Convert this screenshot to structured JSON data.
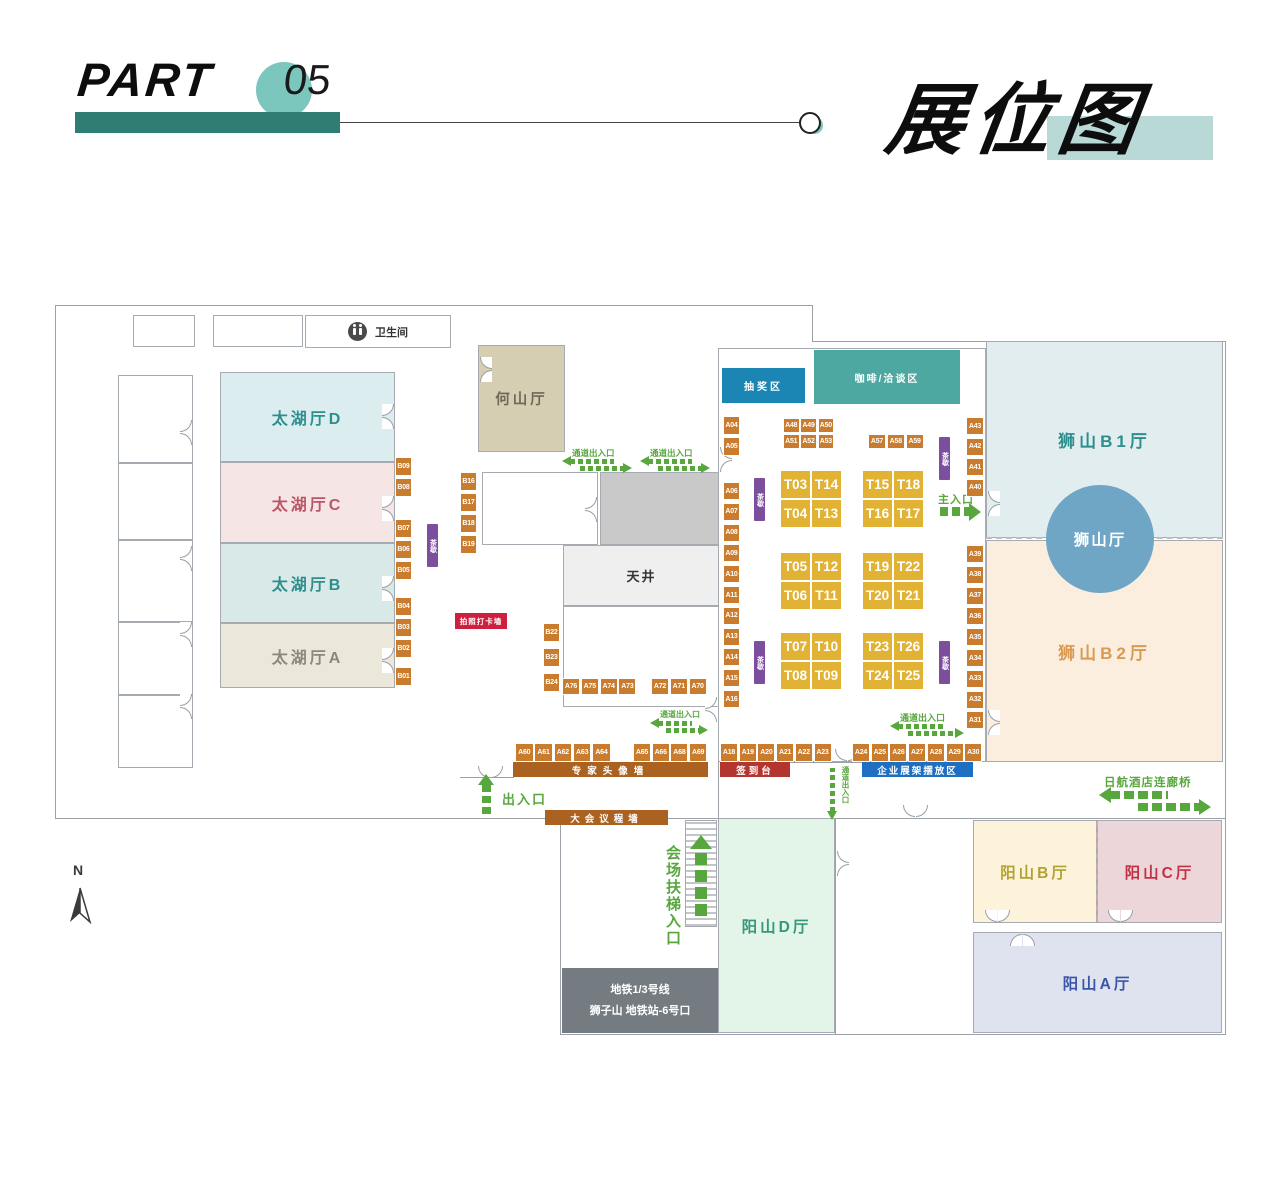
{
  "header": {
    "part_label": "PART",
    "part_number": "05",
    "title": "展位图"
  },
  "compass_label": "N",
  "halls": {
    "taihu_d": "太湖厅D",
    "taihu_c": "太湖厅C",
    "taihu_b": "太湖厅B",
    "taihu_a": "太湖厅A",
    "heshan": "何山厅",
    "tianjing": "天井",
    "shishan_b1": "狮山B1厅",
    "shishan_b2": "狮山B2厅",
    "shishan_circle": "狮山厅",
    "yangshan_a": "阳山A厅",
    "yangshan_b": "阳山B厅",
    "yangshan_c": "阳山C厅",
    "yangshan_d": "阳山D厅"
  },
  "zones": {
    "restroom": "卫生间",
    "lottery": "抽奖区",
    "coffee": "咖啡/洽谈区",
    "photo_wall": "拍照打卡墙",
    "expert_wall": "专家头像墙",
    "signin_desk": "签到台",
    "display_rack": "企业展架摆放区",
    "agenda_wall": "大会议程墙",
    "subway_line1": "地铁1/3号线",
    "subway_line2": "狮子山 地铁站-6号口",
    "corridor_bridge": "日航酒店连廊桥",
    "escalator_entrance": "会场扶梯入口",
    "main_entrance": "主入口",
    "entrance_exit": "出入口",
    "passage": "通道出入口"
  },
  "booths": {
    "b_col_1": [
      "B09",
      "B08"
    ],
    "b_col_2": [
      "B07",
      "B06",
      "B05"
    ],
    "b_col_3": [
      "B04",
      "B03",
      "B02"
    ],
    "b_col_4": [
      "B01"
    ],
    "b_col_5": [
      "B16",
      "B17",
      "B18",
      "B19"
    ],
    "b_col_6": [
      "B22",
      "B23",
      "B24"
    ],
    "a_col_1": [
      "A04",
      "A05"
    ],
    "a_col_2": [
      "A06",
      "A07",
      "A08",
      "A09",
      "A10",
      "A11",
      "A12",
      "A13",
      "A14",
      "A15",
      "A16"
    ],
    "a_col_3": [
      "A43",
      "A42",
      "A41",
      "A40"
    ],
    "a_col_4": [
      "A39",
      "A38",
      "A37",
      "A36",
      "A35",
      "A34",
      "A33",
      "A32",
      "A31"
    ],
    "a_row_48": [
      "A48",
      "A49",
      "A50"
    ],
    "a_row_51": [
      "A51",
      "A52",
      "A53"
    ],
    "a_row_57": [
      "A57",
      "A58",
      "A59"
    ],
    "a_row_76": [
      "A76",
      "A75",
      "A74",
      "A73"
    ],
    "a_row_72": [
      "A72",
      "A71",
      "A70"
    ],
    "a_row_60": [
      "A60",
      "A61",
      "A62",
      "A63",
      "A64"
    ],
    "a_row_65": [
      "A65",
      "A66",
      "A68",
      "A69"
    ],
    "a_row_18": [
      "A18",
      "A19",
      "A20",
      "A21",
      "A22",
      "A23"
    ],
    "a_row_24": [
      "A24",
      "A25",
      "A26",
      "A27",
      "A28",
      "A29",
      "A30"
    ],
    "t_block_1": [
      "T03",
      "T14",
      "T04",
      "T13"
    ],
    "t_block_2": [
      "T15",
      "T18",
      "T16",
      "T17"
    ],
    "t_block_3": [
      "T05",
      "T12",
      "T06",
      "T11"
    ],
    "t_block_4": [
      "T19",
      "T22",
      "T20",
      "T21"
    ],
    "t_block_5": [
      "T07",
      "T10",
      "T08",
      "T09"
    ],
    "t_block_6": [
      "T23",
      "T26",
      "T24",
      "T25"
    ],
    "tea": [
      "茶歇",
      "茶歇",
      "茶歇",
      "茶歇",
      "茶歇"
    ]
  },
  "colors": {
    "accent_teal": "#2f7d73",
    "accent_teal_light": "#7bc6bd",
    "booth_orange": "#c97c2e",
    "booth_yellow": "#e2b234",
    "booth_purple": "#7b4e9e",
    "arrow_green": "#58a73e",
    "lottery_blue": "#1b85b3",
    "coffee_teal": "#4ca8a0",
    "signin_red": "#b23530",
    "rack_blue": "#1e6ec2",
    "wall_brown": "#ab6120",
    "photo_red": "#cf1f3e",
    "subway_gray": "#757c81",
    "shishan_circle_blue": "#6fa6c6"
  }
}
